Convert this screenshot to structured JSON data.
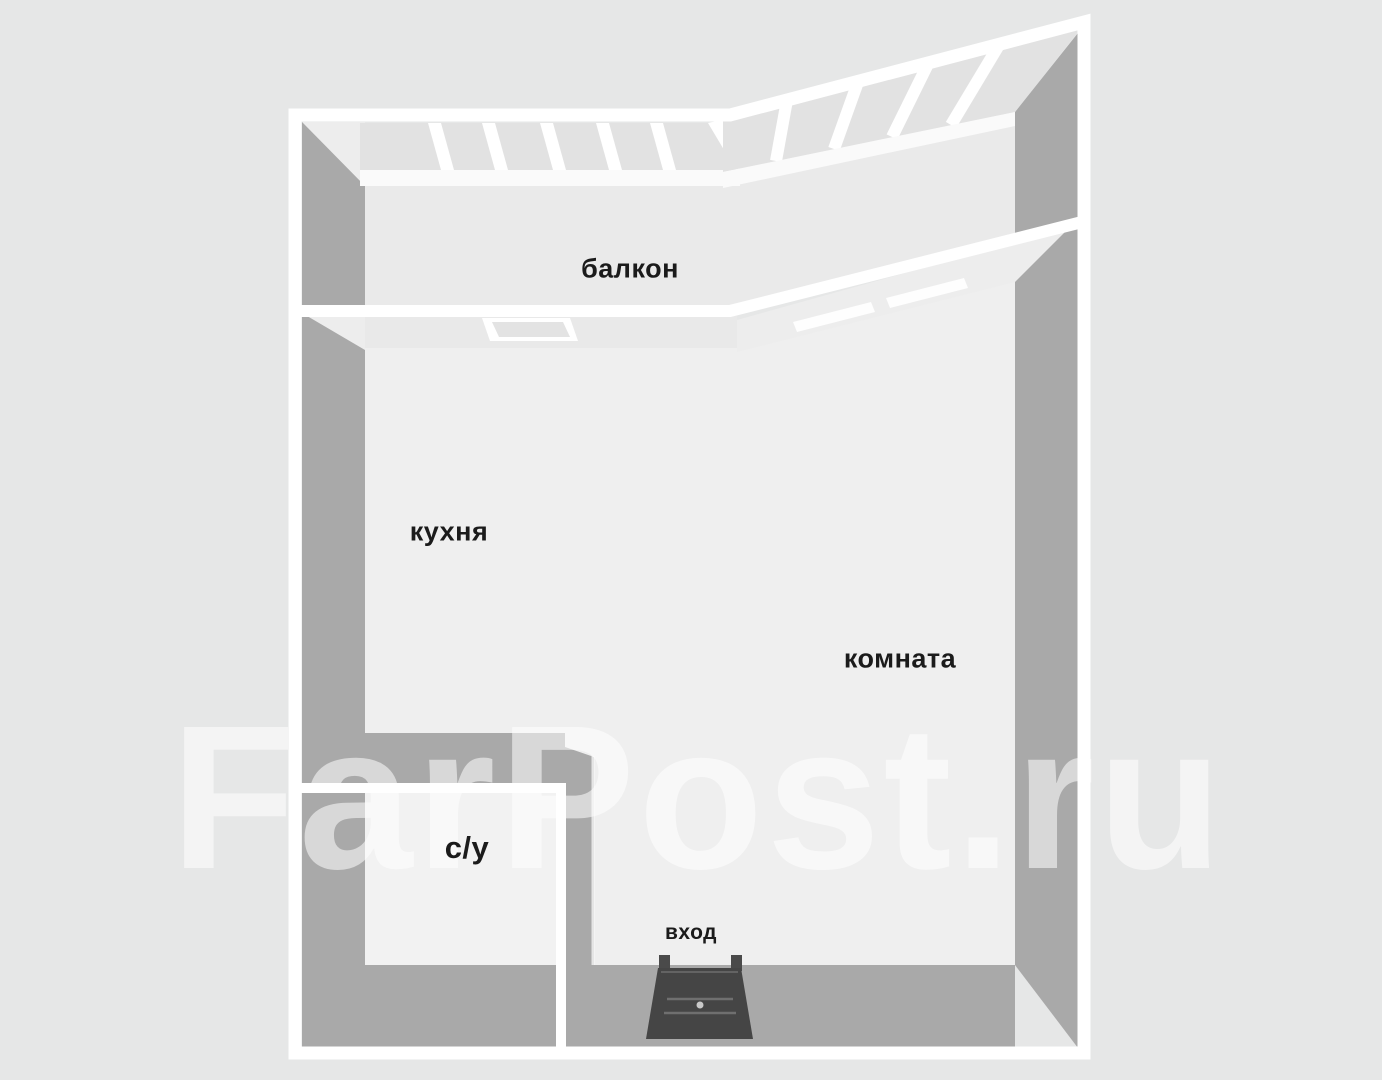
{
  "floorplan": {
    "labels": {
      "balcony": "балкон",
      "kitchen": "кухня",
      "room": "комната",
      "bathroom": "с/у",
      "entrance": "вход"
    },
    "watermark": "FarPost.ru",
    "colors": {
      "background": "#e6e7e7",
      "floor_main": "#efefef",
      "floor_balcony": "#eaeaea",
      "floor_bathroom": "#f2f2f2",
      "wall_face_gray": "#a9a9a9",
      "wall_top_white": "#ffffff",
      "window_pane": "#e2e2e2",
      "door_dark": "#454545",
      "label_text": "#1b1b1b"
    }
  }
}
